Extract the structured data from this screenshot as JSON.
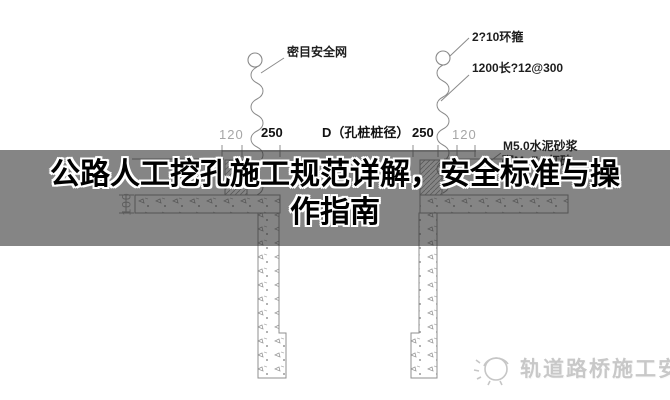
{
  "banner": {
    "title": "公路人工挖孔施工规范详解，安全标准与操作指南",
    "overlay_color": "#262626",
    "title_color": "#000000",
    "outline_color": "#ffffff"
  },
  "diagram": {
    "line_color": "#909090",
    "annotations": {
      "safety_net": "密目安全网",
      "hoop": "2?10环箍",
      "tie_bar": "1200长?12@300",
      "mortar": "M5.0水泥砂浆",
      "brick": "砌Mu7.5红砖"
    },
    "dimensions": {
      "left_120": "120",
      "left_250": "250",
      "pile_diameter": "D（孔桩桩径）",
      "right_250": "250",
      "right_120": "120",
      "depth_100": "100"
    }
  },
  "watermark": {
    "text": "轨道路桥施工安全",
    "color": "#c8c8c8"
  }
}
